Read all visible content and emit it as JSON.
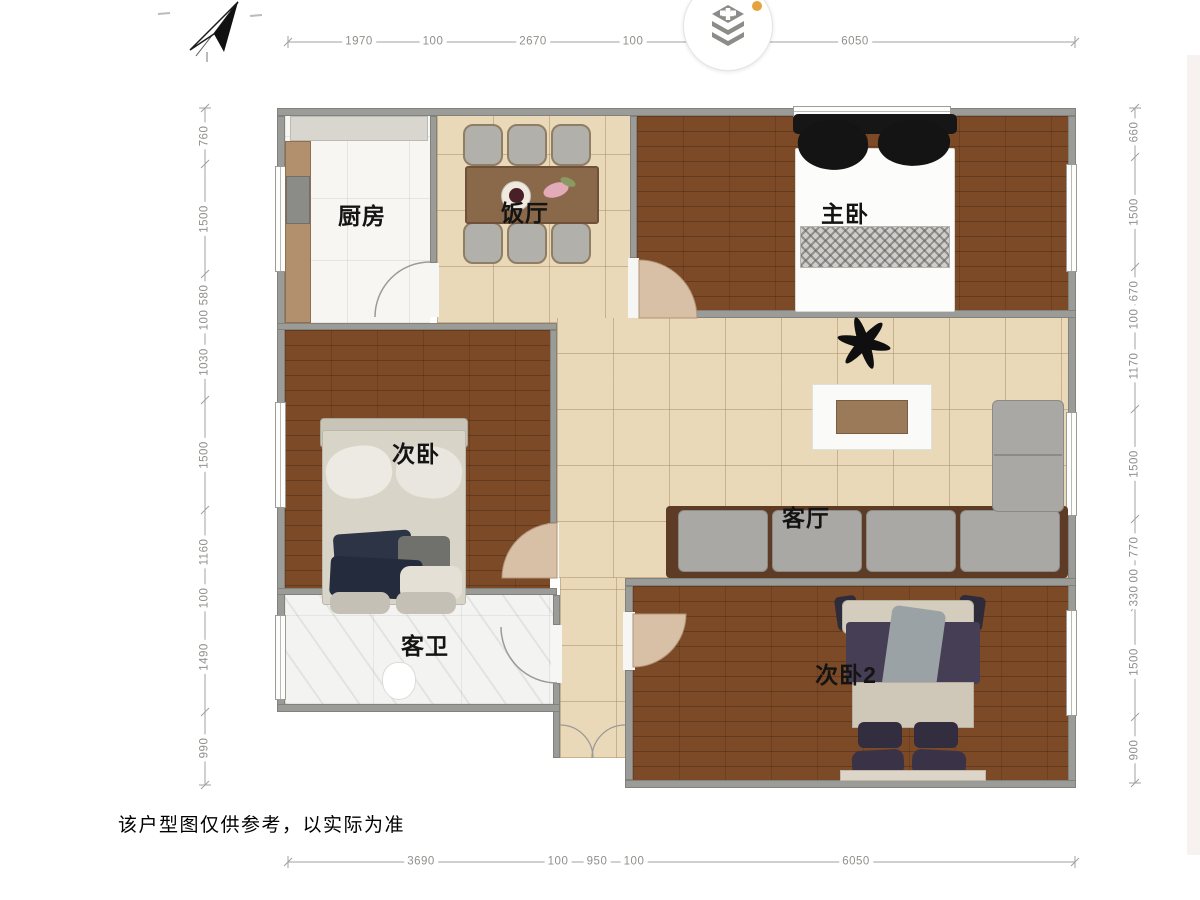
{
  "header": {
    "compass": "north-arrow",
    "layers_button": "floor-stack-toggle"
  },
  "dimensions": {
    "top": [
      "1970",
      "100",
      "2670",
      "100",
      "6050"
    ],
    "bottom": [
      "3690",
      "100",
      "950",
      "100",
      "6050"
    ],
    "left": [
      "760",
      "1500",
      "580",
      "100",
      "1030",
      "1500",
      "1160",
      "100",
      "1490",
      "990"
    ],
    "right": [
      "660",
      "1500",
      "670",
      "100",
      "1170",
      "1500",
      "770",
      "100",
      "330",
      "1500",
      "900"
    ]
  },
  "rooms": {
    "kitchen": "厨房",
    "dining": "饭厅",
    "master_bedroom": "主卧",
    "second_bedroom": "次卧",
    "living_room": "客厅",
    "guest_bathroom": "客卫",
    "second_bedroom_2": "次卧2"
  },
  "disclaimer": "该户型图仅供参考，以实际为准",
  "colors": {
    "wall": "#9b9b98",
    "wood_floor": "#7c4a26",
    "tile_floor": "#ead9b9",
    "kitchen_floor": "#f7f6f2",
    "marble_floor": "#f3f3f1",
    "door_leaf": "#d8c0a6",
    "notification_dot": "#e6a23c"
  }
}
